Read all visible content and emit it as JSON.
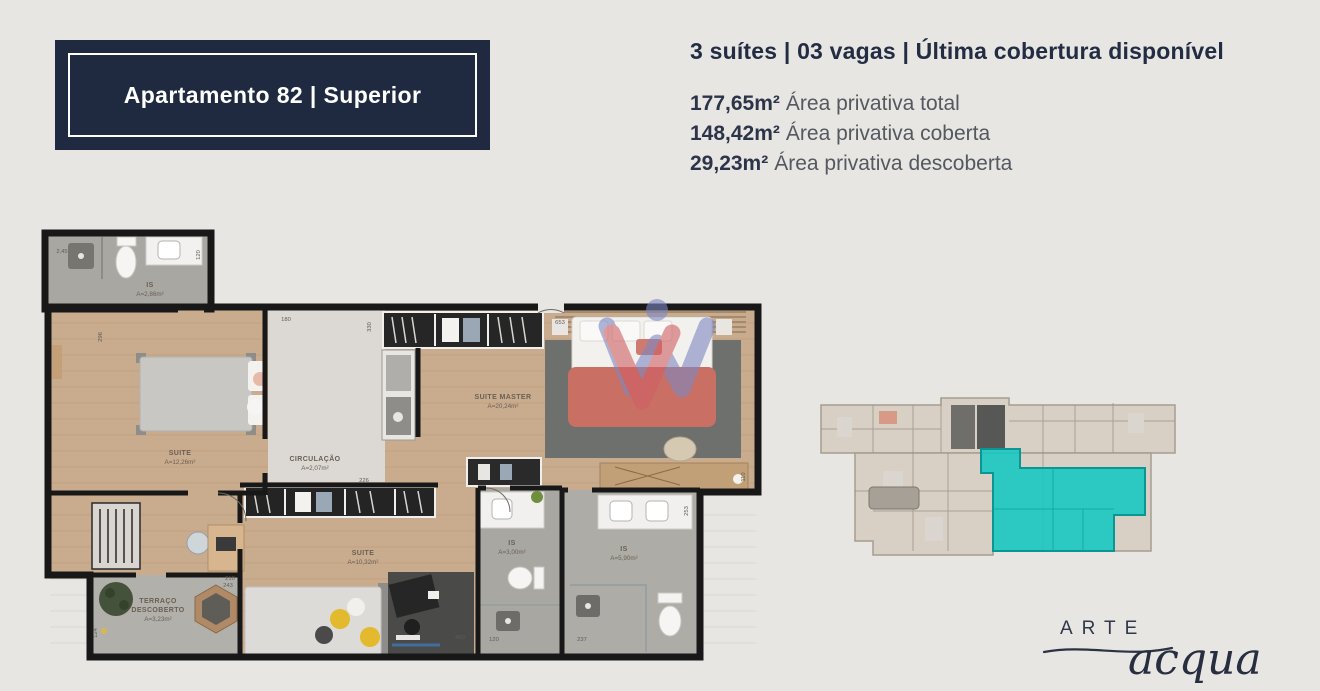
{
  "title_box": {
    "label": "Apartamento 82 | Superior"
  },
  "summary": {
    "headline": "3 suítes | 03 vagas | Última cobertura disponível",
    "areas": [
      {
        "value": "177,65m²",
        "label": "Área privativa total"
      },
      {
        "value": "148,42m²",
        "label": "Área privativa coberta"
      },
      {
        "value": "29,23m²",
        "label": "Área privativa descoberta"
      }
    ]
  },
  "floor_plan": {
    "rooms": [
      {
        "id": "is-upper",
        "name": "IS",
        "area": "A=2,86m²"
      },
      {
        "id": "suite-left",
        "name": "SUITE",
        "area": "A=12,26m²"
      },
      {
        "id": "circulacao",
        "name": "CIRCULAÇÃO",
        "area": "A=2,07m²"
      },
      {
        "id": "suite-master",
        "name": "SUITE MASTER",
        "area": "A=20,24m²"
      },
      {
        "id": "suite-lower",
        "name": "SUITE",
        "area": "A=10,32m²"
      },
      {
        "id": "is-middle",
        "name": "IS",
        "area": "A=3,00m²"
      },
      {
        "id": "is-right",
        "name": "IS",
        "area": "A=5,90m²"
      },
      {
        "id": "terraco",
        "name": "TERRAÇO",
        "name2": "DESCOBERTO",
        "area": "A=3,23m²"
      }
    ],
    "dimensions": {
      "bath_width": "2,45",
      "bath_side": "120",
      "suite_left_side": "296",
      "closet_top": "180",
      "closet_side": "330",
      "master_top": "653",
      "wardrobe_top": "226",
      "office_desk": "210",
      "terrace_top": "243",
      "terrace_side": "124",
      "suite_desk": "400",
      "is_middle_width": "120",
      "is_right_width": "237",
      "is_right_side": "253",
      "master_desk_side": "110"
    }
  },
  "key_plan": {
    "highlight_color": "#13c7c3"
  },
  "watermark": {
    "blue": "#7d87c3",
    "red": "#cf5f63"
  },
  "logo": {
    "line1": "ARTE",
    "line2": "acqua"
  },
  "colors": {
    "navy": "#1f2a41",
    "background": "#e8e6e3",
    "cyan": "#13c7c3"
  }
}
